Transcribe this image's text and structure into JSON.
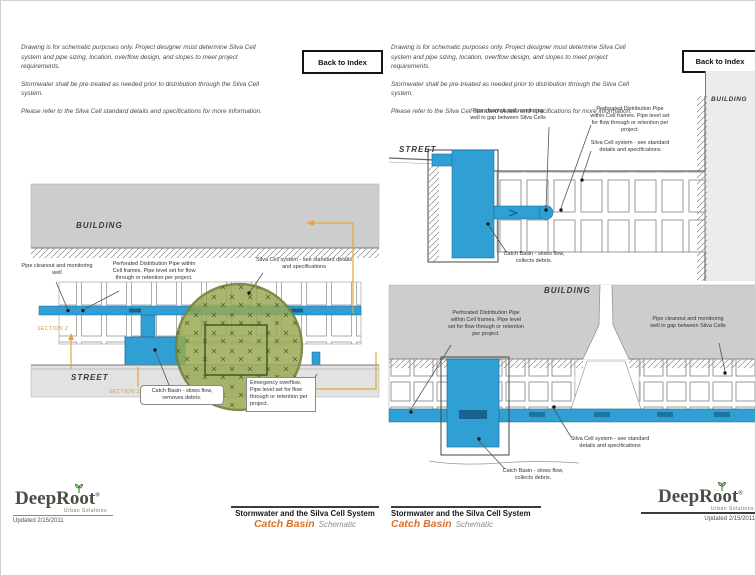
{
  "shared": {
    "back_to_index": "Back to Index",
    "notes": {
      "p1": "Drawing is for schematic purposes only. Project designer must determine Silva Cell system and pipe sizing, location, overflow design, and slopes to meet project requirements.",
      "p2": "Stormwater shall be pre-treated as needed prior to distribution through the Silva Cell system.",
      "p3": "Please refer to the Silva Cell standard details and specifications for more information."
    },
    "labels": {
      "building": "BUILDING",
      "street": "STREET",
      "section_1": "SECTION 1",
      "section_2": "SECTION 2"
    },
    "callouts": {
      "cleanout_plan": "Pipe cleanout and monitoring well",
      "cleanout_section": "Pipe cleanout and monitoring well in gap between Silva Cells",
      "perforated_pipe": "Perforated Distribution Pipe within Cell frames. Pipe level set for flow through or retention per project.",
      "silva_cell_system": "Silva Cell system - see standard details and specifications",
      "emergency_overflow": "Emergency overflow. Pipe level set for flow through or retention per project.",
      "catch_basin_plan": "Catch Basin - slows flow, removes debris.",
      "catch_basin_section": "Catch Basin - slows flow, collects debris."
    },
    "footer": {
      "series_title": "Stormwater and the Silva Cell System",
      "doc_title": "Catch Basin",
      "doc_subtitle": "Schematic",
      "logo_name": "DeepRoot",
      "logo_reg": "®",
      "logo_tagline": "Urban Solutions",
      "updated": "Updated 2/15/2011"
    },
    "colors": {
      "pipe_blue": "#2f9fd4",
      "canopy_green": "#98a851",
      "section_orange": "#e8a43c",
      "accent_orange": "#d96f2b"
    }
  }
}
